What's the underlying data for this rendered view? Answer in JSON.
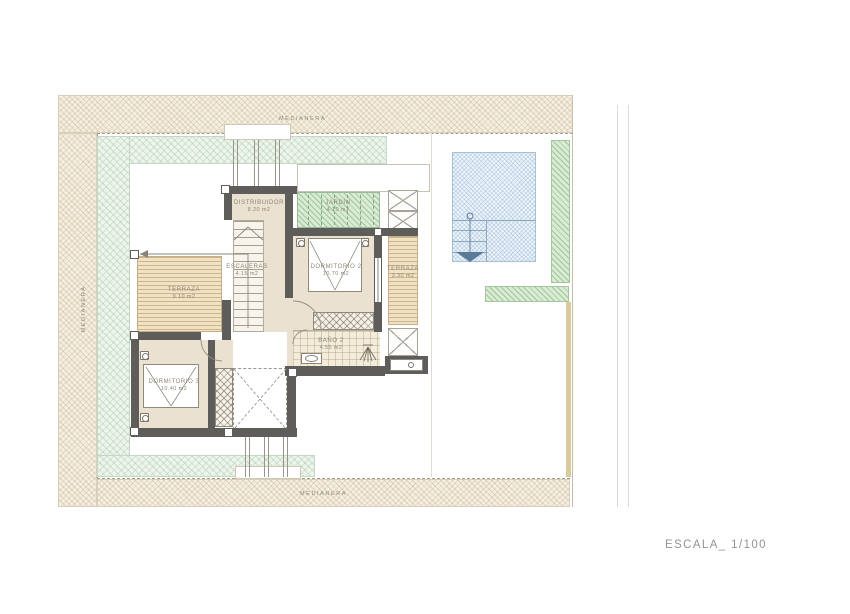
{
  "drawing": {
    "type": "architectural-floor-plan",
    "scale_label": "ESCALA_ 1/100"
  },
  "boundary_labels": {
    "top": "MEDIANERA",
    "left": "MEDIANERA",
    "bottom": "MEDIANERA"
  },
  "rooms": [
    {
      "name": "DISTRIBUIDOR",
      "area": "8.20 m2"
    },
    {
      "name": "JARDÍN",
      "area": "4.10 m2"
    },
    {
      "name": "ESCALERAS",
      "area": "4.15 m2"
    },
    {
      "name": "DORMITORIO 2",
      "area": "10.70 m2"
    },
    {
      "name": "TERRAZA",
      "area": "3.30 m2"
    },
    {
      "name": "TERRAZA",
      "area": "9.10 m2"
    },
    {
      "name": "BAÑO 2",
      "area": "4.55 m2"
    },
    {
      "name": "DORMITORIO 3",
      "area": "10.40 m2"
    }
  ],
  "symbols": [
    "pool-ladder-icon",
    "shower-head-icon",
    "sink-icon",
    "bed-symbol",
    "wall-sconce-icon",
    "stair-direction-arrow",
    "double-height-void-cross"
  ],
  "colors": {
    "wall": "#5f5d5a",
    "room_fill": "#eae1d0",
    "boundary_hatch": "#f5efe2",
    "garden_green": "#d9ecd3",
    "pool_blue": "#eef5fa",
    "deck_tan": "#f0e2c4",
    "label_text": "#8f8678",
    "scale_text": "#939393"
  }
}
